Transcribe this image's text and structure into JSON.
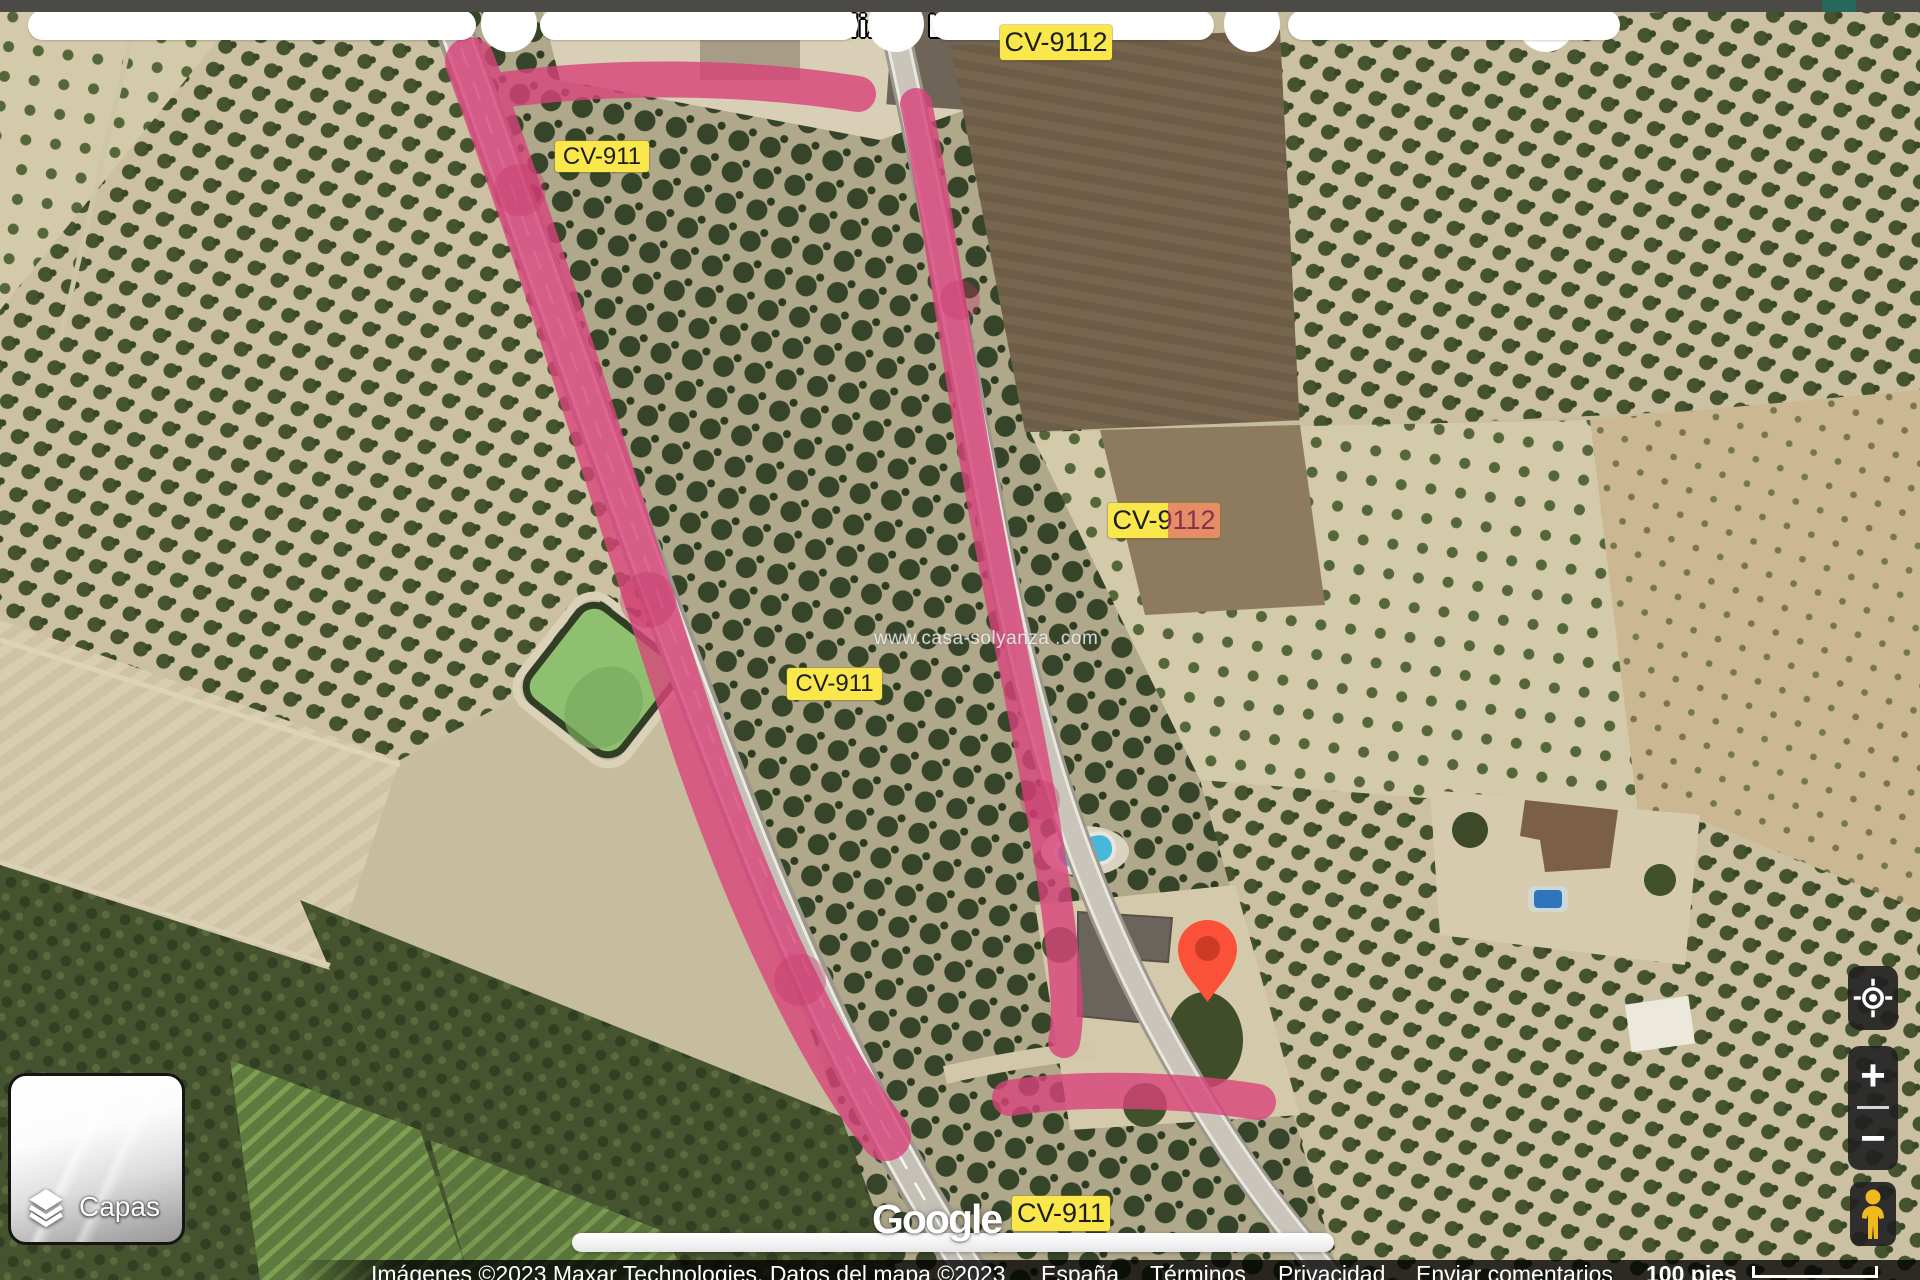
{
  "map": {
    "place_label": "Hortalizas Lati",
    "watermark": "www.casa-solyanza .com",
    "marker_color": "#fb5139",
    "route_highlight_color": "#d9437b",
    "badge_color": "#f9e74b"
  },
  "road_badges": [
    {
      "label": "CV-9112"
    },
    {
      "label": "CV-911"
    },
    {
      "label": "CV-9112"
    },
    {
      "label": "CV-911"
    },
    {
      "label": "CV-911"
    }
  ],
  "layers_control": {
    "label": "Capas"
  },
  "zoom_control": {
    "zoom_in": "+",
    "zoom_out": "−"
  },
  "google_logo": {
    "text": "Google"
  },
  "attribution": {
    "imagery": "Imágenes ©2023 Maxar Technologies, Datos del mapa ©2023",
    "links": [
      {
        "label": "España"
      },
      {
        "label": "Términos"
      },
      {
        "label": "Privacidad"
      },
      {
        "label": "Enviar comentarios"
      }
    ],
    "scale_label": "100 pies"
  }
}
